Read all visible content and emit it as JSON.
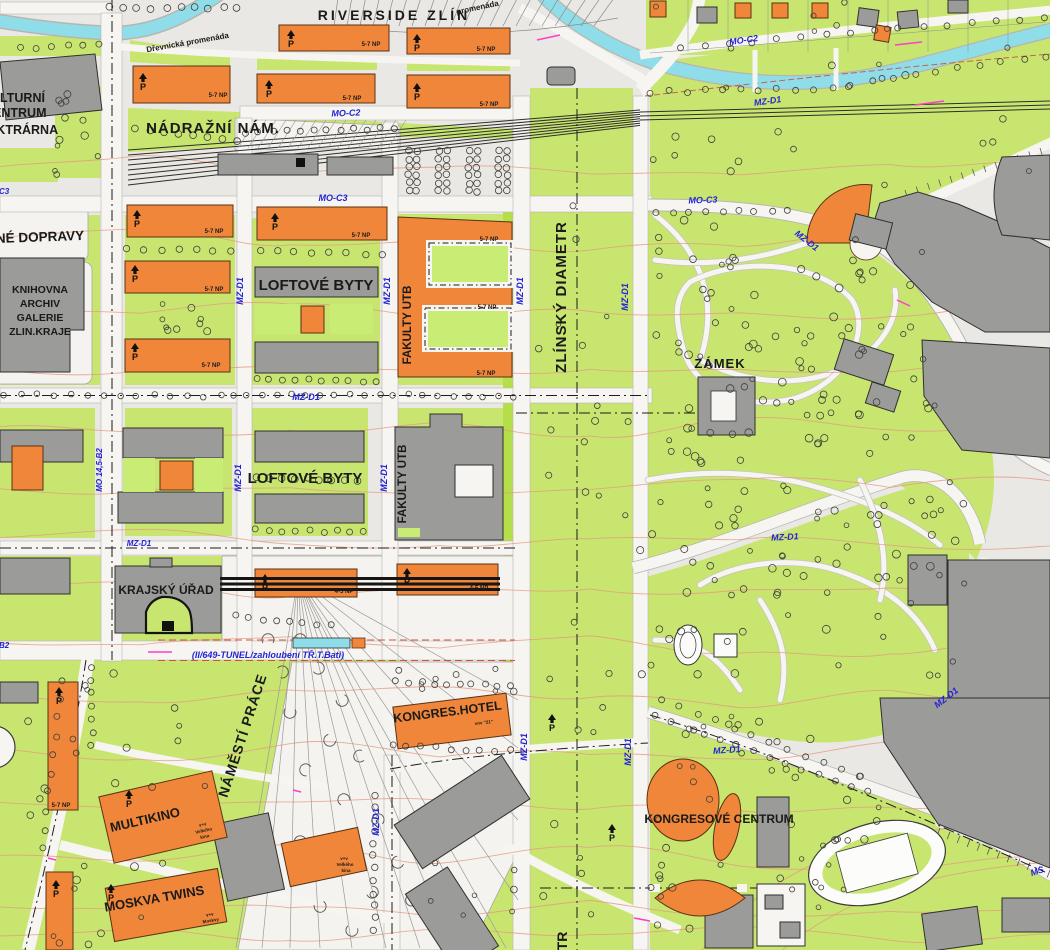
{
  "map": {
    "colors": {
      "base": "#eae8e4",
      "lawn": "#c8e570",
      "lawn2": "#c9ec74",
      "lime": "#b5df4a",
      "street": "#f6f5f2",
      "water": "#8fdde9",
      "water_edge": "#3a9aab",
      "bld_new": "#f0863a",
      "bld_old": "#9b9b99",
      "contour": "#e59a80",
      "road_label": "#2424d6",
      "pink": "#ff3dc8",
      "ink": "#1a1a1a"
    },
    "labels": [
      {
        "t": "RIVERSIDE ZLÍN",
        "x": 394,
        "y": 20,
        "s": 14,
        "w": 700,
        "sp": 3,
        "n": "label-riverside-zlin"
      },
      {
        "t": "NÁDRAŽNÍ NÁM.",
        "x": 213,
        "y": 133,
        "s": 15,
        "w": 600,
        "sp": 1,
        "n": "label-nadrazni-nam"
      },
      {
        "t": "KULTURNÍ",
        "x": -18,
        "y": 102,
        "s": 12.5,
        "w": 600,
        "a": "start",
        "n": "label-kulturni"
      },
      {
        "t": "CENTRUM",
        "x": -16,
        "y": 117,
        "s": 12.5,
        "w": 600,
        "a": "start",
        "n": "label-centrum"
      },
      {
        "t": "ELEKTRÁRNA",
        "x": -28,
        "y": 134,
        "s": 12.5,
        "w": 600,
        "a": "start",
        "n": "label-elektrarna"
      },
      {
        "t": "NÉ DOPRAVY",
        "x": -4,
        "y": 243,
        "s": 13.5,
        "w": 600,
        "a": "start",
        "r": -2,
        "n": "label-dopravy"
      },
      {
        "t": "KNIHOVNA",
        "x": 40,
        "y": 293,
        "s": 10.5,
        "w": 600,
        "n": "label-knihovna"
      },
      {
        "t": "ARCHIV",
        "x": 40,
        "y": 307,
        "s": 10.5,
        "w": 600,
        "n": "label-archiv"
      },
      {
        "t": "GALERIE",
        "x": 40,
        "y": 321,
        "s": 10.5,
        "w": 600,
        "n": "label-galerie"
      },
      {
        "t": "ZLIN.KRAJE",
        "x": 40,
        "y": 335,
        "s": 10.5,
        "w": 600,
        "n": "label-zlin-kraje"
      },
      {
        "t": "LOFTOVÉ BYTY",
        "x": 316,
        "y": 290,
        "s": 15,
        "w": 600,
        "n": "label-loftove-byty-1"
      },
      {
        "t": "LOFTOVÉ BYTY",
        "x": 305,
        "y": 483,
        "s": 15,
        "w": 600,
        "n": "label-loftove-byty-2"
      },
      {
        "t": "FAKULTY UTB",
        "x": 411,
        "y": 325,
        "s": 11.5,
        "w": 600,
        "r": -90,
        "n": "label-fakulty-utb-1"
      },
      {
        "t": "FAKULTY UTB",
        "x": 406,
        "y": 484,
        "s": 11.5,
        "w": 600,
        "r": -90,
        "n": "label-fakulty-utb-2"
      },
      {
        "t": "ZLÍNSKÝ DIAMETR",
        "x": 566,
        "y": 297,
        "s": 15,
        "w": 600,
        "r": -90,
        "sp": 1,
        "n": "label-zlinsky-diametr"
      },
      {
        "t": "TR",
        "x": 567,
        "y": 941,
        "s": 14,
        "w": 600,
        "r": -90,
        "n": "label-diametr-partial"
      },
      {
        "t": "ZÁMEK",
        "x": 720,
        "y": 368,
        "s": 13,
        "w": 600,
        "sp": 1,
        "n": "label-zamek"
      },
      {
        "t": "KRAJSKÝ ÚŘAD",
        "x": 166,
        "y": 594,
        "s": 12,
        "w": 600,
        "n": "label-krajsky-urad"
      },
      {
        "t": "NÁMĚSTÍ PRÁCE",
        "x": 247,
        "y": 737,
        "s": 14,
        "w": 600,
        "r": -72,
        "sp": 1,
        "n": "label-namesti-prace"
      },
      {
        "t": "KONGRES.HOTEL",
        "x": 448,
        "y": 716,
        "s": 12.5,
        "w": 600,
        "r": -7,
        "n": "label-kongres-hotel"
      },
      {
        "t": "vnv \"21\"",
        "x": 484,
        "y": 724,
        "s": 4.5,
        "w": 700,
        "r": -7,
        "n": "label-hotel-note"
      },
      {
        "t": "MULTIKINO",
        "x": 146,
        "y": 824,
        "s": 13,
        "w": 600,
        "r": -13,
        "n": "label-multikino"
      },
      {
        "t": "v+v",
        "x": 203,
        "y": 826,
        "s": 4.5,
        "w": 700,
        "r": -13,
        "n": "label-multikino-note"
      },
      {
        "t": "Velkého",
        "x": 204,
        "y": 832,
        "s": 4.5,
        "w": 700,
        "r": -13,
        "n": "label-multikino-note"
      },
      {
        "t": "kina",
        "x": 205,
        "y": 838,
        "s": 4.5,
        "w": 700,
        "r": -13,
        "n": "label-multikino-note"
      },
      {
        "t": "MOSKVA TWINS",
        "x": 155,
        "y": 903,
        "s": 13,
        "w": 600,
        "r": -10,
        "n": "label-moskva-twins"
      },
      {
        "t": "v+v",
        "x": 210,
        "y": 916,
        "s": 4.5,
        "w": 700,
        "r": -10,
        "n": "label-moskva-note"
      },
      {
        "t": "Moskvy",
        "x": 211,
        "y": 922,
        "s": 4.5,
        "w": 700,
        "r": -10,
        "n": "label-moskva-note"
      },
      {
        "t": "v+v",
        "x": 344,
        "y": 860,
        "s": 4.5,
        "w": 700,
        "n": "label-kino2-note"
      },
      {
        "t": "Velkého",
        "x": 345,
        "y": 866,
        "s": 4.5,
        "w": 700,
        "n": "label-kino2-note"
      },
      {
        "t": "kina",
        "x": 346,
        "y": 872,
        "s": 4.5,
        "w": 700,
        "n": "label-kino2-note"
      },
      {
        "t": "KONGRESOVÉ CENTRUM",
        "x": 719,
        "y": 823,
        "s": 12,
        "w": 600,
        "n": "label-kongresove-centrum"
      },
      {
        "t": "Dřevnická promenáda",
        "x": 188,
        "y": 45,
        "s": 8,
        "w": 600,
        "r": -10,
        "n": "label-drevnicka-promenada"
      },
      {
        "t": "promenáda",
        "x": 478,
        "y": 10,
        "s": 8,
        "w": 600,
        "r": -12,
        "n": "label-promenada"
      },
      {
        "t": "5-7 NP",
        "x": 371,
        "y": 46,
        "s": 6,
        "w": 700,
        "n": "label-np"
      },
      {
        "t": "5-7 NP",
        "x": 486,
        "y": 51,
        "s": 6,
        "w": 700,
        "n": "label-np"
      },
      {
        "t": "5-7 NP",
        "x": 218,
        "y": 97,
        "s": 6,
        "w": 700,
        "n": "label-np"
      },
      {
        "t": "5-7 NP",
        "x": 352,
        "y": 100,
        "s": 6,
        "w": 700,
        "n": "label-np"
      },
      {
        "t": "5-7 NP",
        "x": 489,
        "y": 106,
        "s": 6,
        "w": 700,
        "n": "label-np"
      },
      {
        "t": "5-7 NP",
        "x": 214,
        "y": 233,
        "s": 6,
        "w": 700,
        "n": "label-np"
      },
      {
        "t": "5-7 NP",
        "x": 361,
        "y": 237,
        "s": 6,
        "w": 700,
        "n": "label-np"
      },
      {
        "t": "5-7 NP",
        "x": 489,
        "y": 241,
        "s": 6,
        "w": 700,
        "n": "label-np"
      },
      {
        "t": "5-7 NP",
        "x": 214,
        "y": 291,
        "s": 6,
        "w": 700,
        "n": "label-np"
      },
      {
        "t": "5-7 NP",
        "x": 211,
        "y": 367,
        "s": 6,
        "w": 700,
        "n": "label-np"
      },
      {
        "t": "5-7 NP",
        "x": 487,
        "y": 309,
        "s": 6,
        "w": 700,
        "n": "label-np"
      },
      {
        "t": "5-7 NP",
        "x": 486,
        "y": 375,
        "s": 6,
        "w": 700,
        "n": "label-np"
      },
      {
        "t": "5-7 NP",
        "x": 61,
        "y": 807,
        "s": 6,
        "w": 700,
        "n": "label-np"
      },
      {
        "t": "4-5 NP",
        "x": 344,
        "y": 593,
        "s": 6,
        "w": 700,
        "n": "label-np"
      },
      {
        "t": "4-5 NP",
        "x": 479,
        "y": 590,
        "s": 6,
        "w": 700,
        "n": "label-np"
      },
      {
        "t": "MO-C2",
        "x": 346,
        "y": 116,
        "s": 9,
        "w": 700,
        "r": -2,
        "c": "b",
        "i": 1,
        "n": "label-road-mo-c2"
      },
      {
        "t": "MO-C2",
        "x": 744,
        "y": 43,
        "s": 9,
        "w": 700,
        "r": -8,
        "c": "b",
        "i": 1,
        "n": "label-road-mo-c2"
      },
      {
        "t": "MO-C3",
        "x": 333,
        "y": 201,
        "s": 9,
        "w": 700,
        "c": "b",
        "i": 1,
        "n": "label-road-mo-c3"
      },
      {
        "t": "MO-C3",
        "x": 703,
        "y": 203,
        "s": 9,
        "w": 700,
        "r": -2,
        "c": "b",
        "i": 1,
        "n": "label-road-mo-c3"
      },
      {
        "t": "C3",
        "x": -1,
        "y": 194,
        "s": 8,
        "w": 700,
        "a": "start",
        "c": "b",
        "i": 1,
        "n": "label-road-c3-partial"
      },
      {
        "t": "B2",
        "x": -1,
        "y": 648,
        "s": 8,
        "w": 700,
        "a": "start",
        "c": "b",
        "i": 1,
        "n": "label-road-b2-partial"
      },
      {
        "t": "MZ-D1",
        "x": 768,
        "y": 104,
        "s": 9,
        "w": 700,
        "r": -8,
        "c": "b",
        "i": 1,
        "n": "label-road-mz-d1"
      },
      {
        "t": "MZ-D1",
        "x": 243,
        "y": 291,
        "s": 9,
        "w": 700,
        "r": -90,
        "c": "b",
        "i": 1,
        "n": "label-road-mz-d1"
      },
      {
        "t": "MZ-D1",
        "x": 390,
        "y": 291,
        "s": 9,
        "w": 700,
        "r": -90,
        "c": "b",
        "i": 1,
        "n": "label-road-mz-d1"
      },
      {
        "t": "MZ-D1",
        "x": 523,
        "y": 291,
        "s": 9,
        "w": 700,
        "r": -90,
        "c": "b",
        "i": 1,
        "n": "label-road-mz-d1"
      },
      {
        "t": "MZ-D1",
        "x": 628,
        "y": 297,
        "s": 9,
        "w": 700,
        "r": -90,
        "c": "b",
        "i": 1,
        "n": "label-road-mz-d1"
      },
      {
        "t": "MZ-D1",
        "x": 306,
        "y": 400,
        "s": 9,
        "w": 700,
        "c": "b",
        "i": 1,
        "n": "label-road-mz-d1"
      },
      {
        "t": "MO 14,5-B2",
        "x": 102,
        "y": 470,
        "s": 8,
        "w": 700,
        "r": -90,
        "c": "b",
        "i": 1,
        "n": "label-road-mo-14-5-b2"
      },
      {
        "t": "MZ-D1",
        "x": 241,
        "y": 478,
        "s": 9,
        "w": 700,
        "r": -90,
        "c": "b",
        "i": 1,
        "n": "label-road-mz-d1"
      },
      {
        "t": "MZ-D1",
        "x": 387,
        "y": 478,
        "s": 9,
        "w": 700,
        "r": -90,
        "c": "b",
        "i": 1,
        "n": "label-road-mz-d1"
      },
      {
        "t": "MZ-D1",
        "x": 139,
        "y": 546,
        "s": 8,
        "w": 700,
        "c": "b",
        "i": 1,
        "n": "label-road-mz-d1"
      },
      {
        "t": "MZ-D1",
        "x": 805,
        "y": 243,
        "s": 9,
        "w": 700,
        "r": 38,
        "c": "b",
        "i": 1,
        "n": "label-road-mz-d1"
      },
      {
        "t": "MZ-D1",
        "x": 785,
        "y": 540,
        "s": 9,
        "w": 700,
        "r": -3,
        "c": "b",
        "i": 1,
        "n": "label-road-mz-d1"
      },
      {
        "t": "MZ-D1",
        "x": 948,
        "y": 700,
        "s": 9,
        "w": 700,
        "r": -38,
        "c": "b",
        "i": 1,
        "n": "label-road-mz-d1"
      },
      {
        "t": "MZ-D1",
        "x": 727,
        "y": 753,
        "s": 9,
        "w": 700,
        "r": -4,
        "c": "b",
        "i": 1,
        "n": "label-road-mz-d1"
      },
      {
        "t": "MZ-D1",
        "x": 631,
        "y": 752,
        "s": 9,
        "w": 700,
        "r": -90,
        "c": "b",
        "i": 1,
        "n": "label-road-mz-d1"
      },
      {
        "t": "MZ-D1",
        "x": 527,
        "y": 747,
        "s": 9,
        "w": 700,
        "r": -90,
        "c": "b",
        "i": 1,
        "n": "label-road-mz-d1"
      },
      {
        "t": "MZ-D1",
        "x": 379,
        "y": 822,
        "s": 9,
        "w": 700,
        "r": -90,
        "c": "b",
        "i": 1,
        "n": "label-road-mz-d1"
      },
      {
        "t": "MS",
        "x": 1038,
        "y": 874,
        "s": 9,
        "w": 700,
        "r": -18,
        "c": "b",
        "i": 1,
        "n": "label-road-ms"
      },
      {
        "t": "(II/649-TUNEL/zahloubení TŘ.T.Bati)",
        "x": 268,
        "y": 658,
        "s": 9,
        "w": 700,
        "c": "b",
        "i": 1,
        "n": "label-tunnel"
      }
    ],
    "parking_icons": [
      [
        287,
        30
      ],
      [
        413,
        34
      ],
      [
        139,
        73
      ],
      [
        265,
        80
      ],
      [
        413,
        83
      ],
      [
        133,
        210
      ],
      [
        271,
        213
      ],
      [
        131,
        265
      ],
      [
        131,
        343
      ],
      [
        261,
        574
      ],
      [
        403,
        568
      ],
      [
        55,
        687
      ],
      [
        52,
        880
      ],
      [
        107,
        884
      ],
      [
        125,
        790
      ],
      [
        548,
        714
      ],
      [
        608,
        824
      ]
    ]
  }
}
